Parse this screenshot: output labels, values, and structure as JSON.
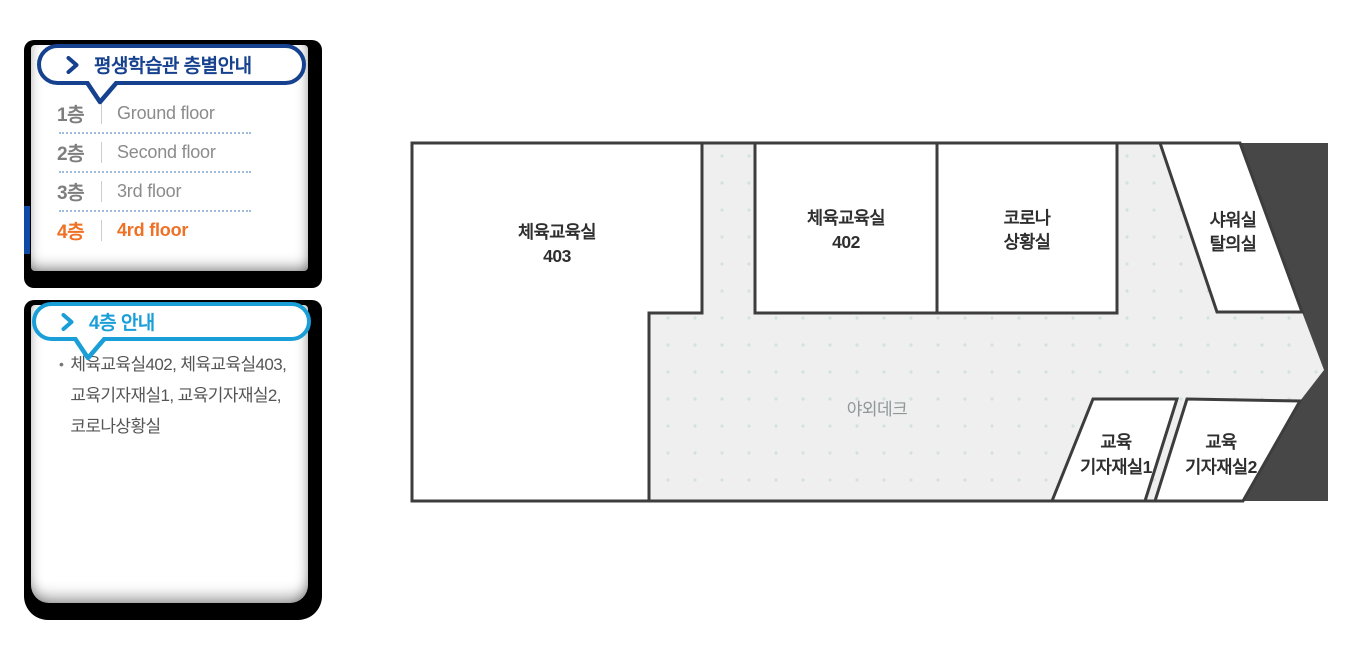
{
  "floor_guide": {
    "title": "평생학습관 층별안내",
    "floors": [
      {
        "num": "1층",
        "label": "Ground floor"
      },
      {
        "num": "2층",
        "label": "Second floor"
      },
      {
        "num": "3층",
        "label": "3rd floor"
      },
      {
        "num": "4층",
        "label": "4rd floor"
      }
    ],
    "active_floor": "4층"
  },
  "floor_info": {
    "title": "4층 안내",
    "bullet_char": "•",
    "text": "체육교육실402, 체육교육실403, 교육기자재실1, 교육기자재실2, 코로나상황실"
  },
  "floor_plan": {
    "rooms": {
      "room403": {
        "lines": [
          "체육교육실",
          "403"
        ]
      },
      "room402": {
        "lines": [
          "체육교육실",
          "402"
        ]
      },
      "corona": {
        "lines": [
          "코로나",
          "상황실"
        ]
      },
      "shower": {
        "lines": [
          "샤워실",
          "탈의실"
        ]
      },
      "deck": {
        "label": "야외데크"
      },
      "equip1": {
        "lines": [
          "교육",
          "기자재실1"
        ]
      },
      "equip2": {
        "lines": [
          "교육",
          "기자재실2"
        ]
      }
    },
    "colors": {
      "wall": "#3d3d3d",
      "room_fill": "#ffffff",
      "deck_fill": "#efefef",
      "deck_dot": "#d5e1e1",
      "dark_fill": "#474747",
      "label": "#2f2f2f",
      "deck_label": "#8f9797"
    }
  },
  "colors": {
    "accent_navy": "#16418f",
    "accent_cyan": "#1a9ed8",
    "active_orange": "#ee7125",
    "active_bar_blue": "#0d4aa5"
  }
}
